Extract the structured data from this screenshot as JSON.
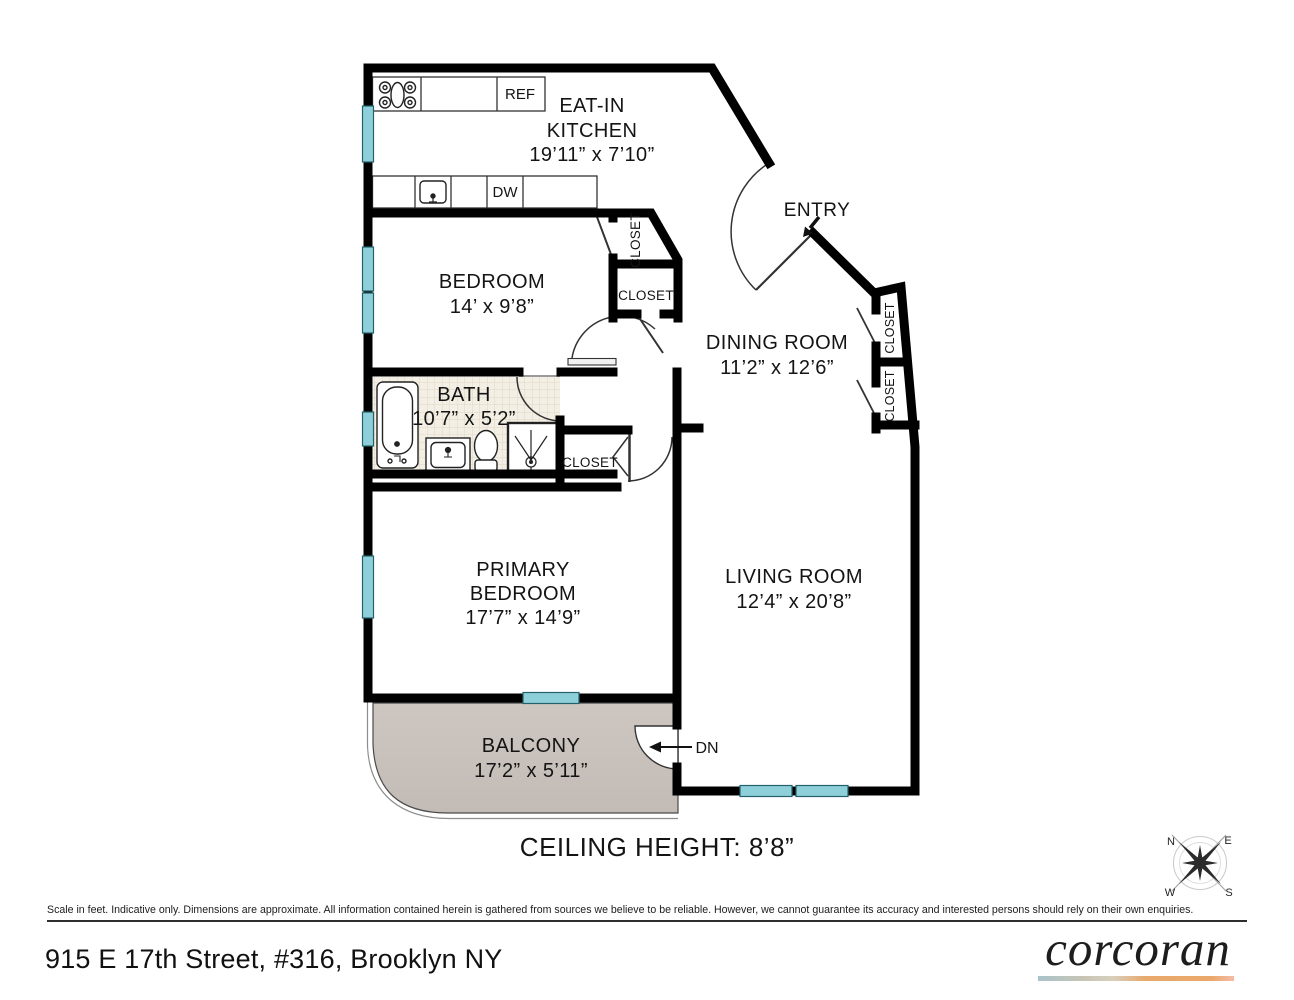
{
  "plan": {
    "kitchen": {
      "line1": "EAT-IN",
      "line2": "KITCHEN",
      "dims": "19’11” x 7’10”"
    },
    "entry": {
      "label": "ENTRY"
    },
    "bedroom": {
      "label": "BEDROOM",
      "dims": "14’ x 9’8”"
    },
    "dining": {
      "label": "DINING ROOM",
      "dims": "11’2” x 12’6”"
    },
    "bath": {
      "label": "BATH",
      "dims": "10’7” x 5’2”"
    },
    "primary": {
      "line1": "PRIMARY",
      "line2": "BEDROOM",
      "dims": "17’7” x 14’9”"
    },
    "living": {
      "label": "LIVING ROOM",
      "dims": "12’4” x 20’8”"
    },
    "balcony": {
      "label": "BALCONY",
      "dims": "17’2” x 5’11”"
    },
    "closet_label": "CLOSET",
    "ref_label": "REF",
    "dw_label": "DW",
    "dn_label": "DN",
    "ceiling_note": "CEILING HEIGHT: 8’8”"
  },
  "compass": {
    "n": "N",
    "e": "E",
    "w": "W",
    "s": "S"
  },
  "footer": {
    "disclaimer": "Scale in feet. Indicative only. Dimensions are approximate. All information contained herein is gathered from sources we believe to be reliable. However, we cannot guarantee its accuracy and interested persons should rely on their own enquiries.",
    "address": "915 E 17th Street, #316, Brooklyn NY",
    "brand": "corcoran"
  },
  "colors": {
    "wall": "#000000",
    "window": "#8ed0d9",
    "balcony_fill": "#c9c2bd",
    "bath_tile": "#f3efe4",
    "logo_gradient": [
      "#a9c3c9",
      "#d8cfbc",
      "#e8a96c",
      "#f3bca4"
    ]
  }
}
